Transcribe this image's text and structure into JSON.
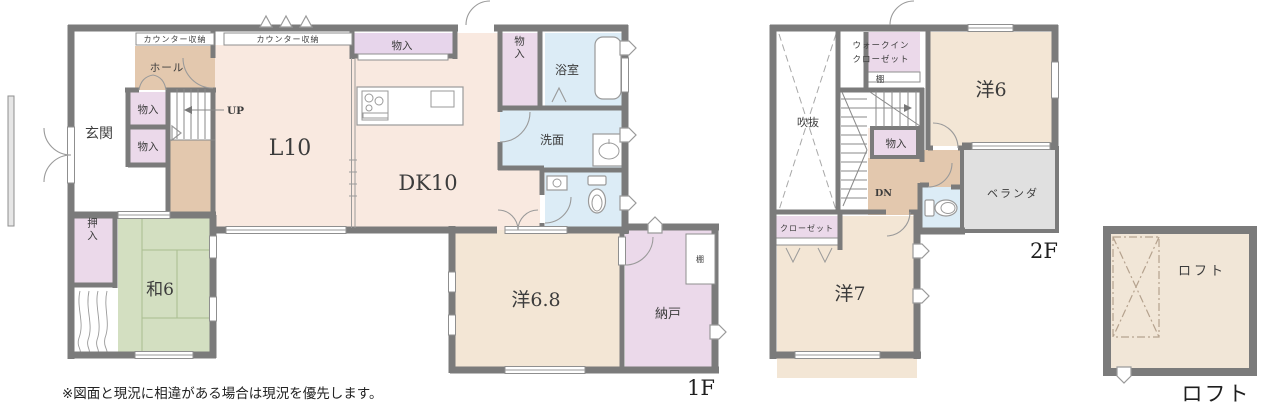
{
  "palette": {
    "wall": "#7b7b7b",
    "ldk_pink": "#f9e9e0",
    "hallway_tan": "#e3c8ae",
    "storage_pink": "#ebd9ea",
    "sanitary_blue": "#dcecf6",
    "tatami_green": "#d3dfc1",
    "western_beige": "#f3e6d5",
    "veranda_gray": "#e0e0e0"
  },
  "note": "※図面と現況に相違がある場合は現況を優先します。",
  "f1": {
    "floor_label": "1F",
    "genkan": "玄関",
    "counter_storage_1": "カウンター収納",
    "counter_storage_2": "カウンター収納",
    "hall": "ホール",
    "storage_1": "物入",
    "storage_2": "物入",
    "storage_3": "物入",
    "storage_4": "物入",
    "up": "UP",
    "living": "L10",
    "dining_kitchen": "DK10",
    "bath": "浴室",
    "washroom": "洗面",
    "japanese_room": "和6",
    "oshiire": "押入",
    "western_room": "洋6.8",
    "storage_room": "納戸",
    "shelf": "棚"
  },
  "f2": {
    "floor_label": "2F",
    "void": "吹抜",
    "wic_line1": "ウォークイン",
    "wic_line2": "クローゼット",
    "shelf": "棚",
    "storage": "物入",
    "dn": "DN",
    "western_room_6": "洋6",
    "veranda": "ベランダ",
    "closet": "クローゼット",
    "western_room_7": "洋7"
  },
  "loft": {
    "room": "ロフト",
    "caption": "ロフト"
  }
}
